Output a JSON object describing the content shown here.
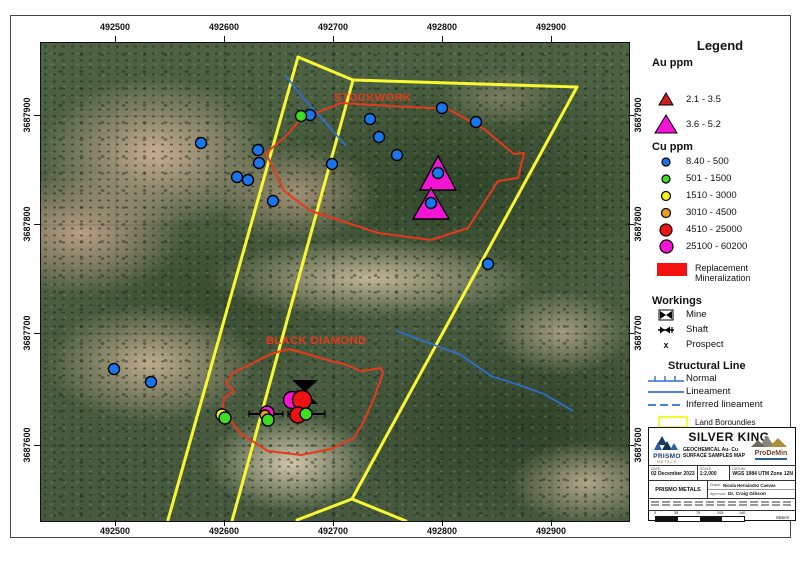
{
  "map": {
    "north_label": "N",
    "x_ticks": [
      {
        "label": "492500",
        "px": 115
      },
      {
        "label": "492600",
        "px": 224
      },
      {
        "label": "492700",
        "px": 333
      },
      {
        "label": "492800",
        "px": 442
      },
      {
        "label": "492900",
        "px": 551
      }
    ],
    "y_ticks": [
      {
        "label": "3687900",
        "py": 115
      },
      {
        "label": "3687800",
        "py": 224
      },
      {
        "label": "3687700",
        "py": 333
      },
      {
        "label": "3687600",
        "py": 445
      }
    ],
    "colors": {
      "boundary": "#f8f832",
      "zone": "#e8391c",
      "lineament": "#2f6fd6",
      "graticule": "rgba(40,40,40,0.40)"
    },
    "classes": {
      "cu1": {
        "color": "#1875eb"
      },
      "cu2": {
        "color": "#3fdd20"
      },
      "cu3": {
        "color": "#f4f01e"
      },
      "cu4": {
        "color": "#f09c1a"
      },
      "cu5": {
        "color": "#ee1212"
      },
      "cu6": {
        "color": "#f414d6"
      },
      "au2": {
        "color": "#f414d6"
      }
    },
    "zones": [
      {
        "name": "STOCKWORK",
        "label_x": 293,
        "label_y": 58,
        "points": [
          [
            225,
            110
          ],
          [
            243,
            95
          ],
          [
            260,
            76
          ],
          [
            300,
            60
          ],
          [
            350,
            63
          ],
          [
            407,
            66
          ],
          [
            443,
            86
          ],
          [
            473,
            111
          ],
          [
            483,
            110
          ],
          [
            477,
            135
          ],
          [
            457,
            138
          ],
          [
            427,
            185
          ],
          [
            390,
            197
          ],
          [
            337,
            190
          ],
          [
            310,
            181
          ],
          [
            270,
            168
          ],
          [
            243,
            148
          ],
          [
            230,
            121
          ]
        ]
      },
      {
        "name": "BLACK DIAMOND",
        "label_x": 225,
        "label_y": 301,
        "points": [
          [
            192,
            330
          ],
          [
            185,
            340
          ],
          [
            193,
            348
          ],
          [
            183,
            355
          ],
          [
            182,
            365
          ],
          [
            190,
            378
          ],
          [
            200,
            391
          ],
          [
            227,
            408
          ],
          [
            260,
            412
          ],
          [
            290,
            406
          ],
          [
            313,
            395
          ],
          [
            323,
            378
          ],
          [
            333,
            355
          ],
          [
            342,
            330
          ],
          [
            340,
            325
          ],
          [
            320,
            328
          ],
          [
            303,
            321
          ],
          [
            290,
            318
          ],
          [
            263,
            310
          ],
          [
            247,
            306
          ],
          [
            230,
            311
          ],
          [
            210,
            321
          ]
        ]
      }
    ],
    "yellow_lines": [
      [
        [
          257,
          14
        ],
        [
          127,
          477
        ]
      ],
      [
        [
          257,
          14
        ],
        [
          312,
          37
        ]
      ],
      [
        [
          312,
          37
        ],
        [
          191,
          478
        ]
      ],
      [
        [
          312,
          37
        ],
        [
          536,
          44
        ]
      ],
      [
        [
          536,
          44
        ],
        [
          311,
          456
        ]
      ],
      [
        [
          311,
          456
        ],
        [
          256,
          477
        ]
      ],
      [
        [
          311,
          456
        ],
        [
          365,
          478
        ]
      ]
    ],
    "blue_lines": [
      [
        [
          245,
          33
        ],
        [
          262,
          55
        ],
        [
          284,
          79
        ],
        [
          305,
          103
        ]
      ],
      [
        [
          356,
          288
        ],
        [
          420,
          312
        ],
        [
          450,
          333
        ],
        [
          475,
          341
        ],
        [
          503,
          351
        ],
        [
          532,
          368
        ]
      ]
    ],
    "graticule": {
      "xs": [
        75,
        184,
        293,
        402,
        511
      ],
      "ys": [
        73,
        182,
        291,
        403
      ]
    },
    "triangles": [
      {
        "points": [
          [
            397,
            113
          ],
          [
            379,
            147
          ],
          [
            415,
            147
          ]
        ],
        "c": "au2"
      },
      {
        "points": [
          [
            390,
            145
          ],
          [
            372,
            176
          ],
          [
            408,
            176
          ]
        ],
        "c": "au2"
      }
    ],
    "mine": [
      [
        251,
        337
      ],
      [
        277,
        337
      ],
      [
        251,
        361
      ],
      [
        277,
        361
      ]
    ],
    "shaft_lines": [
      [
        [
          208,
          371
        ],
        [
          242,
          371
        ]
      ],
      [
        [
          247,
          371
        ],
        [
          284,
          371
        ]
      ]
    ],
    "samples": [
      {
        "x": 160,
        "y": 100,
        "r": 5.5,
        "c": "cu1"
      },
      {
        "x": 269,
        "y": 72,
        "r": 5.5,
        "c": "cu1"
      },
      {
        "x": 329,
        "y": 76,
        "r": 5.5,
        "c": "cu1"
      },
      {
        "x": 401,
        "y": 65,
        "r": 5.5,
        "c": "cu1"
      },
      {
        "x": 435,
        "y": 79,
        "r": 5.5,
        "c": "cu1"
      },
      {
        "x": 338,
        "y": 94,
        "r": 5.5,
        "c": "cu1"
      },
      {
        "x": 356,
        "y": 112,
        "r": 5.5,
        "c": "cu1"
      },
      {
        "x": 291,
        "y": 121,
        "r": 5.5,
        "c": "cu1"
      },
      {
        "x": 217,
        "y": 107,
        "r": 5.5,
        "c": "cu1"
      },
      {
        "x": 218,
        "y": 120,
        "r": 5.5,
        "c": "cu1"
      },
      {
        "x": 196,
        "y": 134,
        "r": 5.5,
        "c": "cu1"
      },
      {
        "x": 207,
        "y": 137,
        "r": 5.5,
        "c": "cu1"
      },
      {
        "x": 232,
        "y": 158,
        "r": 5.5,
        "c": "cu1"
      },
      {
        "x": 73,
        "y": 326,
        "r": 5.5,
        "c": "cu1"
      },
      {
        "x": 110,
        "y": 339,
        "r": 5.5,
        "c": "cu1"
      },
      {
        "x": 447,
        "y": 221,
        "r": 5.5,
        "c": "cu1"
      },
      {
        "x": 260,
        "y": 73,
        "r": 5.5,
        "c": "cu2"
      },
      {
        "x": 397,
        "y": 130,
        "r": 5.5,
        "c": "cu1"
      },
      {
        "x": 390,
        "y": 160,
        "r": 5.5,
        "c": "cu1"
      },
      {
        "x": 181,
        "y": 372,
        "r": 6,
        "c": "cu3"
      },
      {
        "x": 184,
        "y": 375,
        "r": 6,
        "c": "cu2"
      },
      {
        "x": 226,
        "y": 370,
        "r": 7,
        "c": "cu6"
      },
      {
        "x": 224,
        "y": 372,
        "r": 5,
        "c": "cu4"
      },
      {
        "x": 227,
        "y": 377,
        "r": 6,
        "c": "cu2"
      },
      {
        "x": 251,
        "y": 357,
        "r": 8.5,
        "c": "cu6"
      },
      {
        "x": 261,
        "y": 357,
        "r": 9.5,
        "c": "cu5"
      },
      {
        "x": 257,
        "y": 372,
        "r": 8,
        "c": "cu5"
      },
      {
        "x": 265,
        "y": 371,
        "r": 6,
        "c": "cu2"
      }
    ]
  },
  "legend": {
    "title": "Legend",
    "au_title": "Au ppm",
    "au_classes": [
      {
        "label": "2.1 - 3.5",
        "color": "#cf1d1d"
      },
      {
        "label": "3.6 - 5.2",
        "color": "#f414d6"
      }
    ],
    "cu_title": "Cu ppm",
    "cu_classes": [
      {
        "label": "8.40 - 500",
        "color": "#1875eb"
      },
      {
        "label": "501 - 1500",
        "color": "#3fdd20"
      },
      {
        "label": "1510 - 3000",
        "color": "#f4f01e"
      },
      {
        "label": "3010 - 4500",
        "color": "#f09c1a"
      },
      {
        "label": "4510 - 25000",
        "color": "#ee1212"
      },
      {
        "label": "25100 - 60200",
        "color": "#f414d6"
      }
    ],
    "replacement": {
      "line1": "Replacement",
      "line2": "Mineralization",
      "color": "#f50f0f"
    },
    "workings": {
      "title": "Workings",
      "items": [
        "Mine",
        "Shaft",
        "Prospect"
      ],
      "prospect_glyph": "x"
    },
    "structural": {
      "title": "Structural Line",
      "items": [
        "Normal",
        "Lineament",
        "Inferred lineament"
      ],
      "color": "#2f6fd6"
    },
    "land": {
      "label": "Land Boroundies",
      "color": "#f8f832"
    }
  },
  "title_block": {
    "project": "SILVER KING",
    "subtitle_1": "GEOCHEMICAL Au- Cu",
    "subtitle_2": "SURFACE SAMPLES MAP",
    "company_logo": "PRISMO",
    "company_logo_sub": "METALS",
    "prodemin": "ProDeMin",
    "date_label": "DATE:",
    "date": "02 December 2023",
    "scale_label": "SCALE:",
    "scale": "1:2,000",
    "datum_label": "DATUM:",
    "datum": "WGS 1984 UTM Zone 12N",
    "company": "PRISMO METALS",
    "drawn_label": "Drawn:",
    "drawn": "Nicola Hernández Cuevas",
    "approved_label": "Approved:",
    "approved": "Dr. Craig Gibson",
    "scalebar": [
      "0",
      "35",
      "70",
      "105",
      "140"
    ],
    "meters": "Meters"
  }
}
